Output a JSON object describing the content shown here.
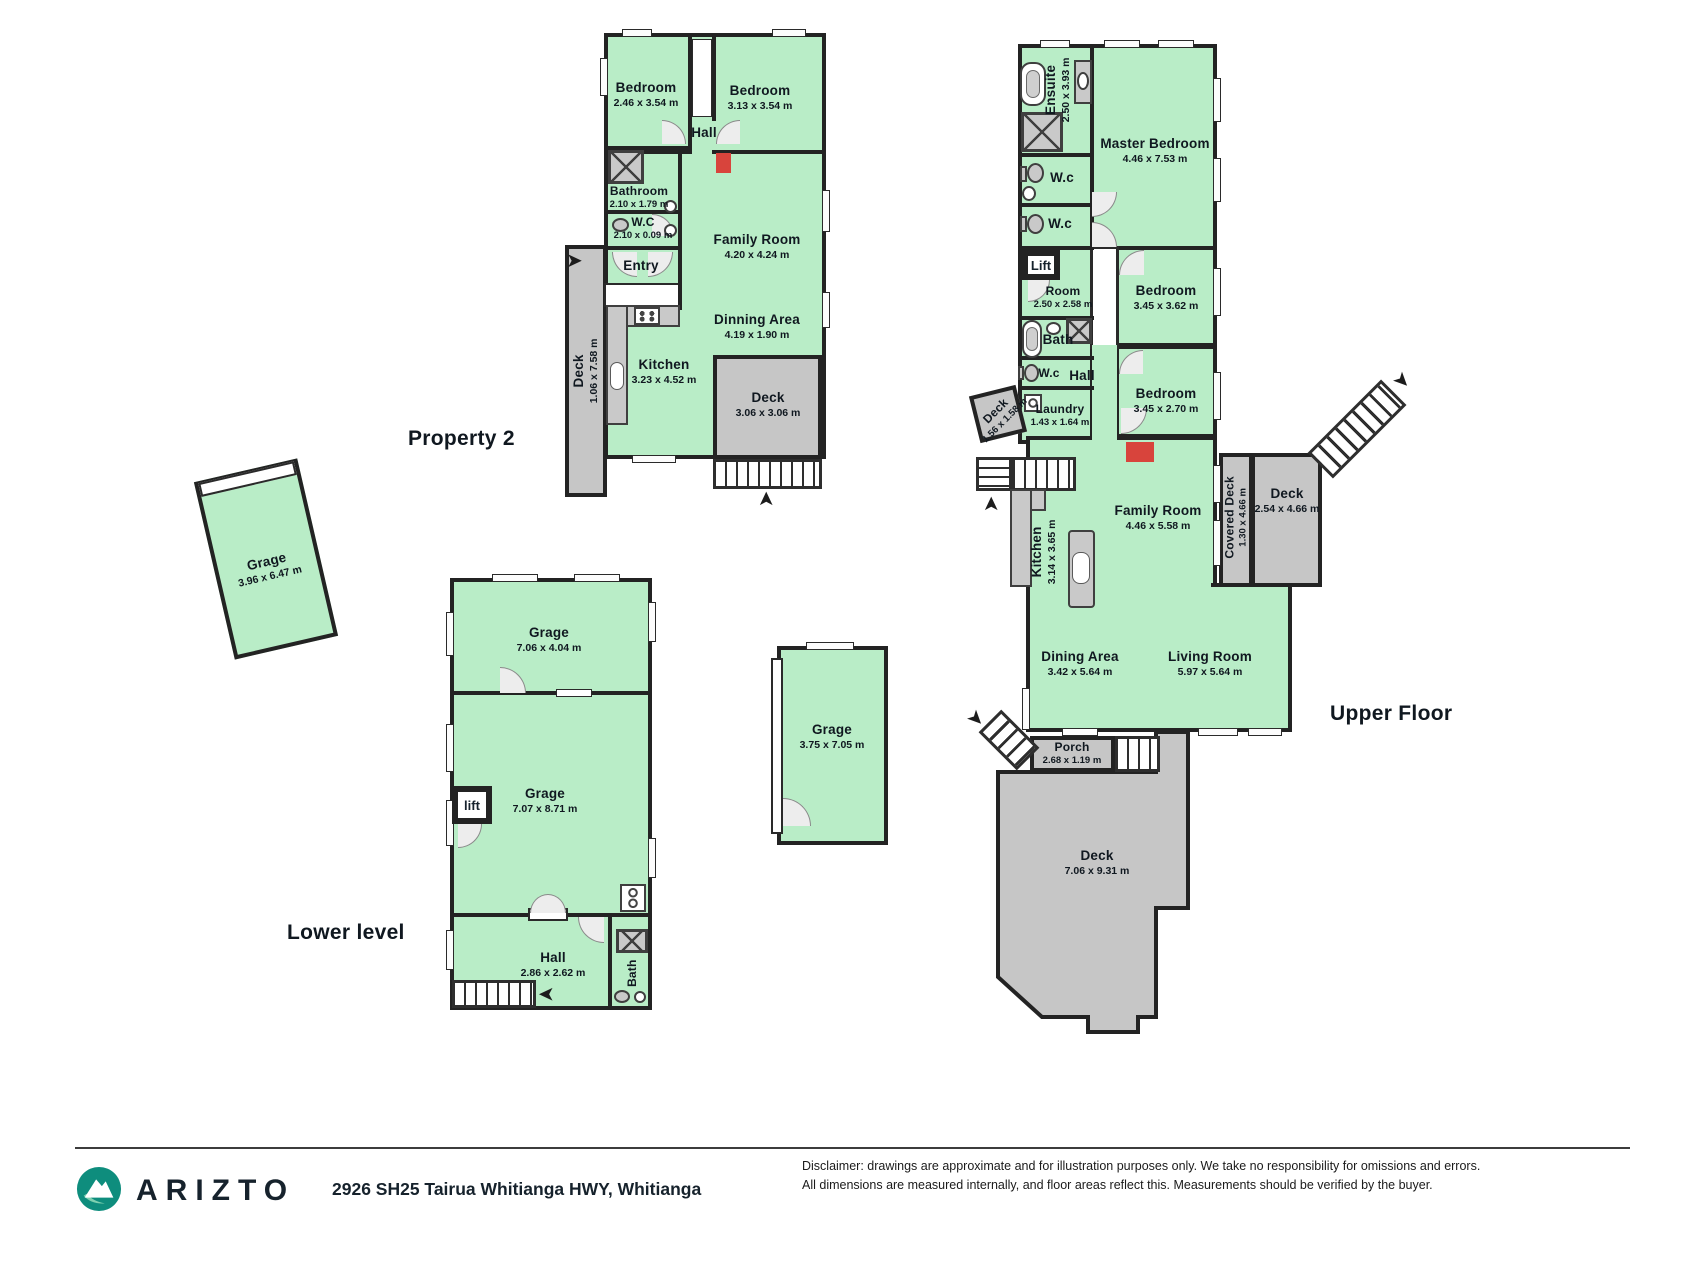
{
  "colors": {
    "room_fill": "#b9edc7",
    "wall": "#232323",
    "deck_fill": "#c6c6c6",
    "accent_red": "#d8443c",
    "brand_teal": "#0e8d7d",
    "ink": "#16222c"
  },
  "icons": {
    "arrow": "➤"
  },
  "titles": {
    "p2": "Property 2",
    "lower": "Lower level",
    "upper": "Upper Floor"
  },
  "p2": {
    "bed1": {
      "name": "Bedroom",
      "dims": "2.46 x 3.54 m"
    },
    "bed2": {
      "name": "Bedroom",
      "dims": "3.13 x 3.54 m"
    },
    "hall": {
      "name": "Hall"
    },
    "bathroom": {
      "name": "Bathroom",
      "dims": "2.10 x 1.79 m"
    },
    "wc": {
      "name": "W.C",
      "dims": "2.10 x 0.09 m"
    },
    "entry": {
      "name": "Entry"
    },
    "deck_side": {
      "name": "Deck",
      "dims": "1.06 x 7.58 m"
    },
    "family": {
      "name": "Family Room",
      "dims": "4.20 x 4.24 m"
    },
    "dinning": {
      "name": "Dinning Area",
      "dims": "4.19 x 1.90 m"
    },
    "kitchen": {
      "name": "Kitchen",
      "dims": "3.23 x 4.52 m"
    },
    "deck_rear": {
      "name": "Deck",
      "dims": "3.06 x 3.06 m"
    }
  },
  "garage_a": {
    "name": "Grage",
    "dims": "3.96 x 6.47 m"
  },
  "garage_b": {
    "name": "Grage",
    "dims": "3.75 x 7.05 m"
  },
  "lower": {
    "garage_top": {
      "name": "Grage",
      "dims": "7.06 x 4.04 m"
    },
    "garage_main": {
      "name": "Grage",
      "dims": "7.07 x 8.71 m"
    },
    "lift": {
      "name": "lift"
    },
    "hall": {
      "name": "Hall",
      "dims": "2.86 x 2.62 m"
    },
    "bath": {
      "name": "Bath"
    }
  },
  "upper": {
    "ensuite": {
      "name": "Ensuite",
      "dims": "2.50 x 3.93 m"
    },
    "master": {
      "name": "Master Bedroom",
      "dims": "4.46 x 7.53 m"
    },
    "wc1": {
      "name": "W.c"
    },
    "wc2": {
      "name": "W.c"
    },
    "lift": {
      "name": "Lift"
    },
    "room": {
      "name": "Room",
      "dims": "2.50 x 2.58 m"
    },
    "bed1": {
      "name": "Bedroom",
      "dims": "3.45 x 3.62 m"
    },
    "bath": {
      "name": "Bath"
    },
    "wc3": {
      "name": "W.c"
    },
    "hall": {
      "name": "Hall"
    },
    "deck_small": {
      "name": "Deck",
      "dims": "1.56 x 1.58 m"
    },
    "laundry": {
      "name": "Laundry",
      "dims": "1.43 x 1.64 m"
    },
    "bed2": {
      "name": "Bedroom",
      "dims": "3.45 x 2.70 m"
    },
    "family": {
      "name": "Family Room",
      "dims": "4.46 x 5.58 m"
    },
    "kitchen": {
      "name": "Kitchen",
      "dims": "3.14 x 3.65 m"
    },
    "covered_deck": {
      "name": "Covered Deck",
      "dims": "1.30 x 4.66 m"
    },
    "deck_upper": {
      "name": "Deck",
      "dims": "2.54 x 4.66 m"
    },
    "dining": {
      "name": "Dining Area",
      "dims": "3.42 x 5.64 m"
    },
    "living": {
      "name": "Living Room",
      "dims": "5.97 x 5.64 m"
    },
    "porch": {
      "name": "Porch",
      "dims": "2.68 x 1.19 m"
    },
    "deck_main": {
      "name": "Deck",
      "dims": "7.06 x 9.31 m"
    }
  },
  "footer": {
    "brand": "ARIZTO",
    "address": "2926 SH25 Tairua Whitianga HWY, Whitianga",
    "disclaimer_line1": "Disclaimer: drawings are approximate and for illustration purposes only. We take no responsibility for omissions and errors.",
    "disclaimer_line2": "All dimensions are measured internally, and floor areas reflect this. Measurements should be verified by the buyer."
  }
}
